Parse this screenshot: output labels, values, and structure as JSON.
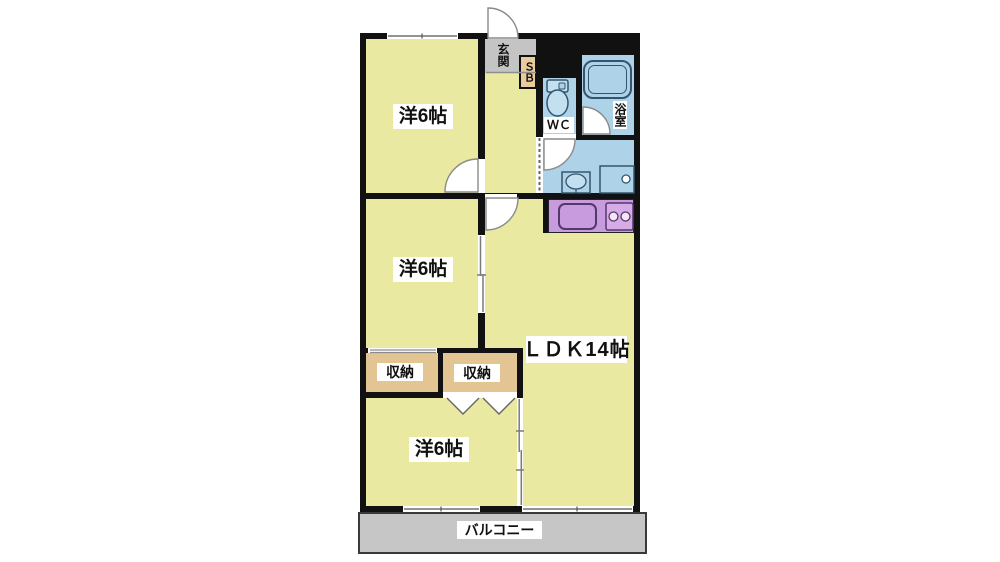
{
  "floorplan": {
    "labels": {
      "room_top": "洋6帖",
      "room_middle": "洋6帖",
      "room_bottom": "洋6帖",
      "ldk": "ＬＤＫ14帖",
      "entrance": "玄関",
      "shoe_box": "ＳＢ",
      "wc": "ＷＣ",
      "bath": "浴室",
      "closet_left": "収納",
      "closet_right": "収納",
      "balcony": "バルコニー"
    },
    "colors": {
      "wall": "#111111",
      "floor_yellow": "#e9e9a2",
      "wet_area_blue": "#aed3e8",
      "kitchen_purple": "#c89ade",
      "closet_tan": "#e3c493",
      "entrance_gray": "#c6c6c6",
      "balcony_gray": "#c6c6c6",
      "fixture_outline": "#33566e"
    }
  }
}
